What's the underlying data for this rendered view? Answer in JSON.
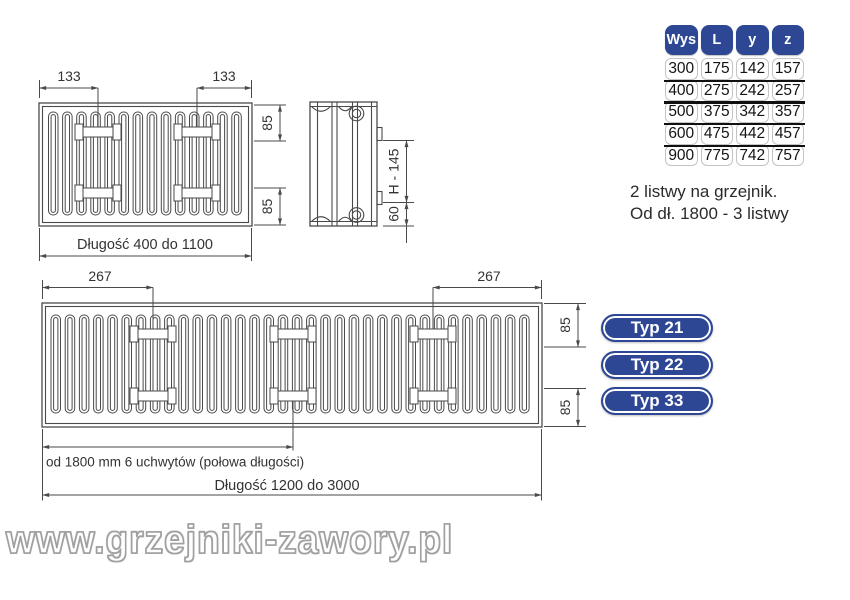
{
  "drawing_front": {
    "dim_left_bracket": "133",
    "dim_right_bracket": "133",
    "dim_top_right": "85",
    "dim_bottom_right": "85",
    "length_label": "Długość 400 do 1100"
  },
  "drawing_side": {
    "height_label": "H - 145",
    "bottom_label": "60"
  },
  "drawing_long": {
    "dim_left_bracket": "267",
    "dim_right_bracket": "267",
    "dim_top_right": "85",
    "dim_bottom_right": "85",
    "half_length_label": "od 1800 mm 6 uchwytów (połowa długości)",
    "length_label": "Długość 1200 do 3000"
  },
  "spec_table": {
    "headers": [
      "Wys",
      "L",
      "y",
      "z"
    ],
    "rows": [
      [
        "300",
        "175",
        "142",
        "157"
      ],
      [
        "400",
        "275",
        "242",
        "257"
      ],
      [
        "500",
        "375",
        "342",
        "357"
      ],
      [
        "600",
        "475",
        "442",
        "457"
      ],
      [
        "900",
        "775",
        "742",
        "757"
      ]
    ]
  },
  "note": {
    "line1": "2 listwy na grzejnik.",
    "line2": "Od dł. 1800 - 3 listwy"
  },
  "type_buttons": [
    {
      "label": "Typ 21"
    },
    {
      "label": "Typ 22"
    },
    {
      "label": "Typ 33"
    }
  ],
  "watermark": "www.grzejniki-zawory.pl",
  "colors": {
    "accent_blue": "#2d4795",
    "drawing_line": "#4a4a4a",
    "row_separator": "#101010",
    "watermark_outline": "#a0a0a0"
  }
}
